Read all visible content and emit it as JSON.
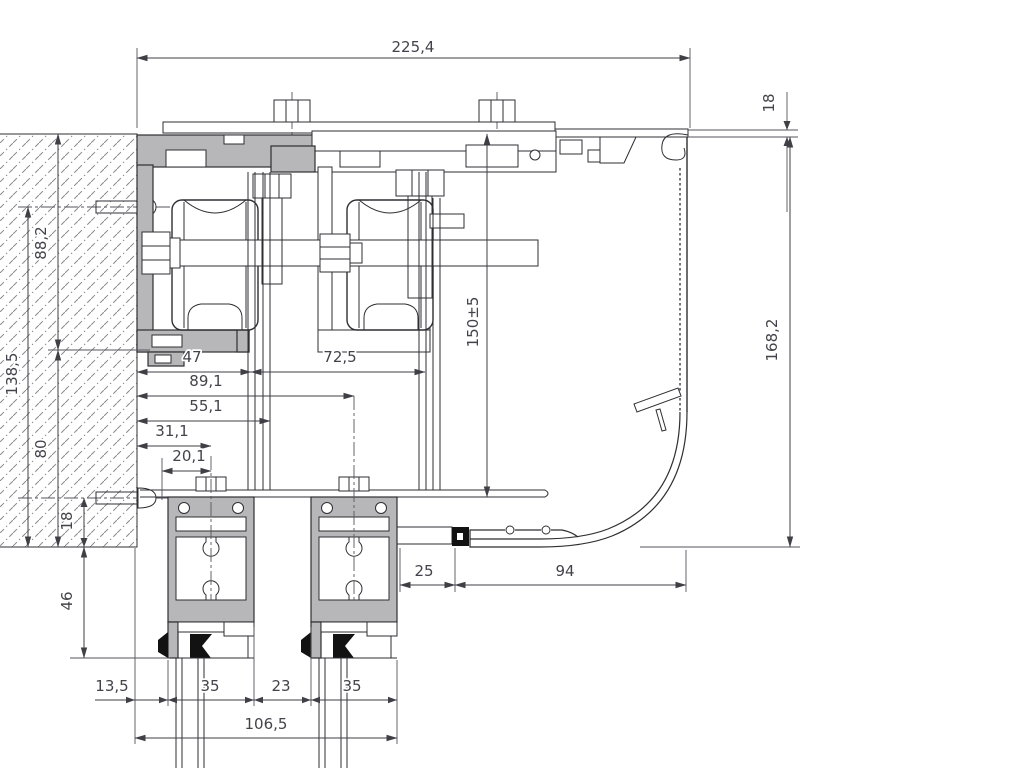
{
  "drawing": {
    "dims": {
      "overall_width": "225,4",
      "cover_lip_thickness": "18",
      "cover_height": "168,2",
      "suspension_height": "150±5",
      "wall_upper_span": "88,2",
      "wall_anchor_span": "138,5",
      "wall_lower_span": "80",
      "wall_bottom_offset": "18",
      "leaf_top_drop": "46",
      "roller1_offset": "47",
      "roller_spacing": "72,5",
      "leaf2_axis": "89,1",
      "bracket_offset": "55,1",
      "leaf1_axis": "31,1",
      "leaf1_inner_offset": "20,1",
      "sill_clearance": "25",
      "sill_width": "94",
      "wall_to_leaf1": "13,5",
      "leaf1_width": "35",
      "leaf_gap": "23",
      "leaf2_width": "35",
      "leaf_assembly_width": "106,5"
    },
    "colors": {
      "aluminum_fill": "#b7b7b9",
      "outline": "#2f2f33",
      "dimension": "#3f3f46",
      "gasket": "#121212",
      "background": "#ffffff"
    }
  }
}
